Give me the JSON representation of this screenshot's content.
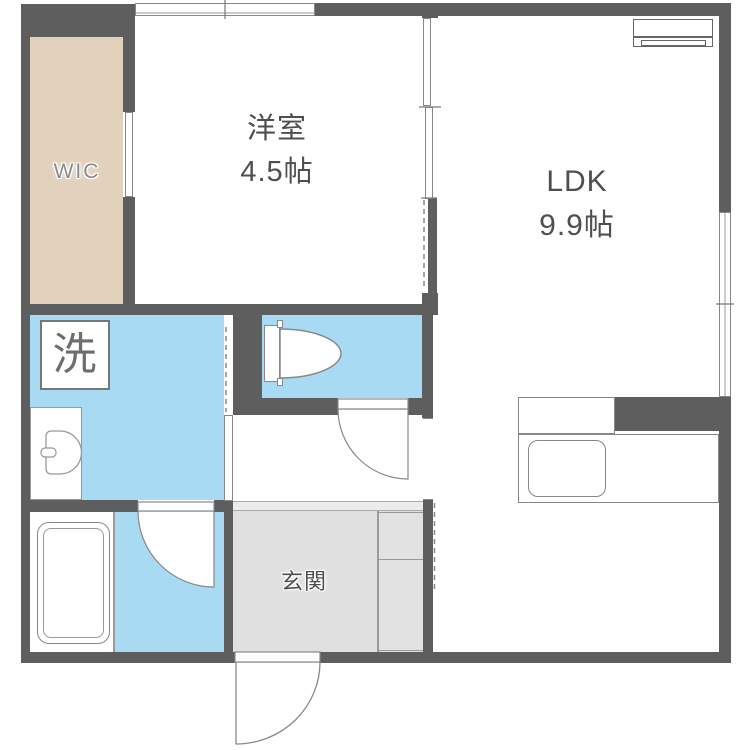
{
  "plan": {
    "rooms": {
      "wic": {
        "label": "WIC"
      },
      "western_room": {
        "label": "洋室",
        "size": "4.5帖"
      },
      "ldk": {
        "label": "LDK",
        "size": "9.9帖"
      },
      "genkan": {
        "label": "玄関"
      },
      "laundry": {
        "label": "洗"
      }
    },
    "colors": {
      "wall": "#5e5e5e",
      "water_area": "#a8daf3",
      "wic_floor": "#e2d2bd",
      "genkan_floor": "#e0e0e0",
      "genkan_step": "#ececec",
      "fixture_outline": "#888888",
      "label_text": "#4f4f4f"
    },
    "fixtures": [
      "air-conditioner",
      "washing-machine-space",
      "washbasin",
      "toilet",
      "bathtub",
      "kitchen-counter",
      "kitchen-sink",
      "shoe-cabinet",
      "entrance-door",
      "bathroom-door",
      "toilet-door"
    ]
  }
}
